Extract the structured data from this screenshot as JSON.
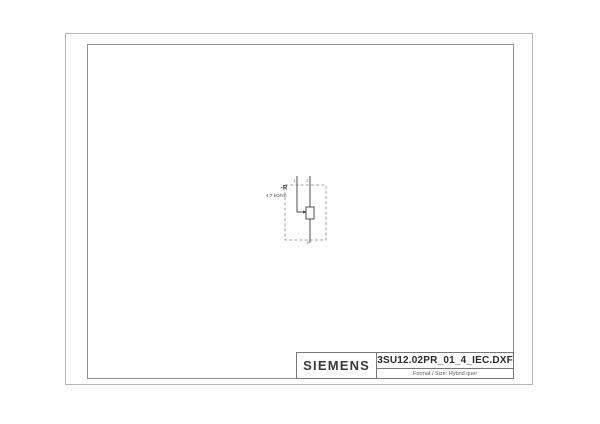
{
  "sheet": {
    "background": "#ffffff",
    "frame_outer_color": "#b5b5b5",
    "frame_inner_color": "#8f8f8f"
  },
  "title_block": {
    "brand": "SIEMENS",
    "filename": "3SU12.02PR_01_4_IEC.DXF",
    "format_label": "Format / Size: Hybrid quer"
  },
  "schematic": {
    "symbol": "potentiometer",
    "component_ref": "-R",
    "component_value": "4,7 kOhm",
    "terminals": {
      "top_left": "1",
      "top_right": "2",
      "bottom": "3"
    },
    "line_color": "#4d4d4d",
    "dashed_outline_color": "#858585"
  }
}
